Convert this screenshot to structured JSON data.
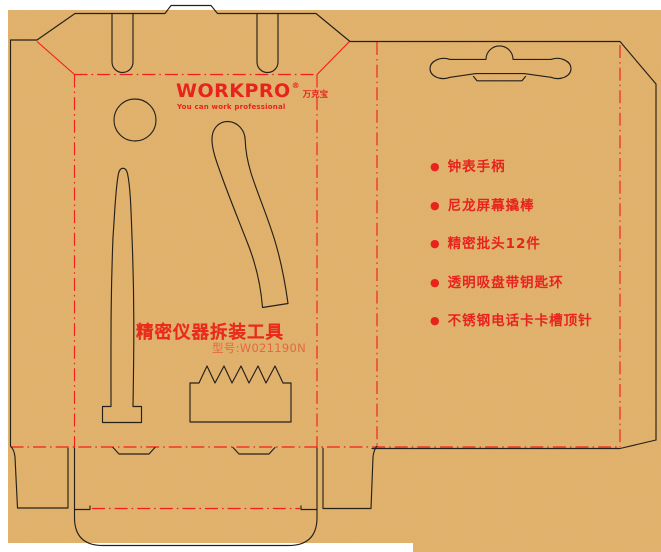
{
  "brand": {
    "logo": "WORKPRO",
    "registered_mark": "®",
    "brand_cn": "万克宝",
    "tagline": "You can work professional"
  },
  "product": {
    "title": "精密仪器拆装工具",
    "model": "型号:W021190N"
  },
  "contents": {
    "bullet": "●",
    "items": [
      "钟表手柄",
      "尼龙屏幕撬棒",
      "精密批头12件",
      "透明吸盘带钥匙环",
      "不锈钢电话卡卡槽顶针"
    ]
  },
  "colors": {
    "background": "#ffffff",
    "cardboard": "#e5b46c",
    "cut_line": "#26201a",
    "fold_line": "#f51d1d",
    "print_red": "#e8231e",
    "model_red": "#e06a42"
  }
}
